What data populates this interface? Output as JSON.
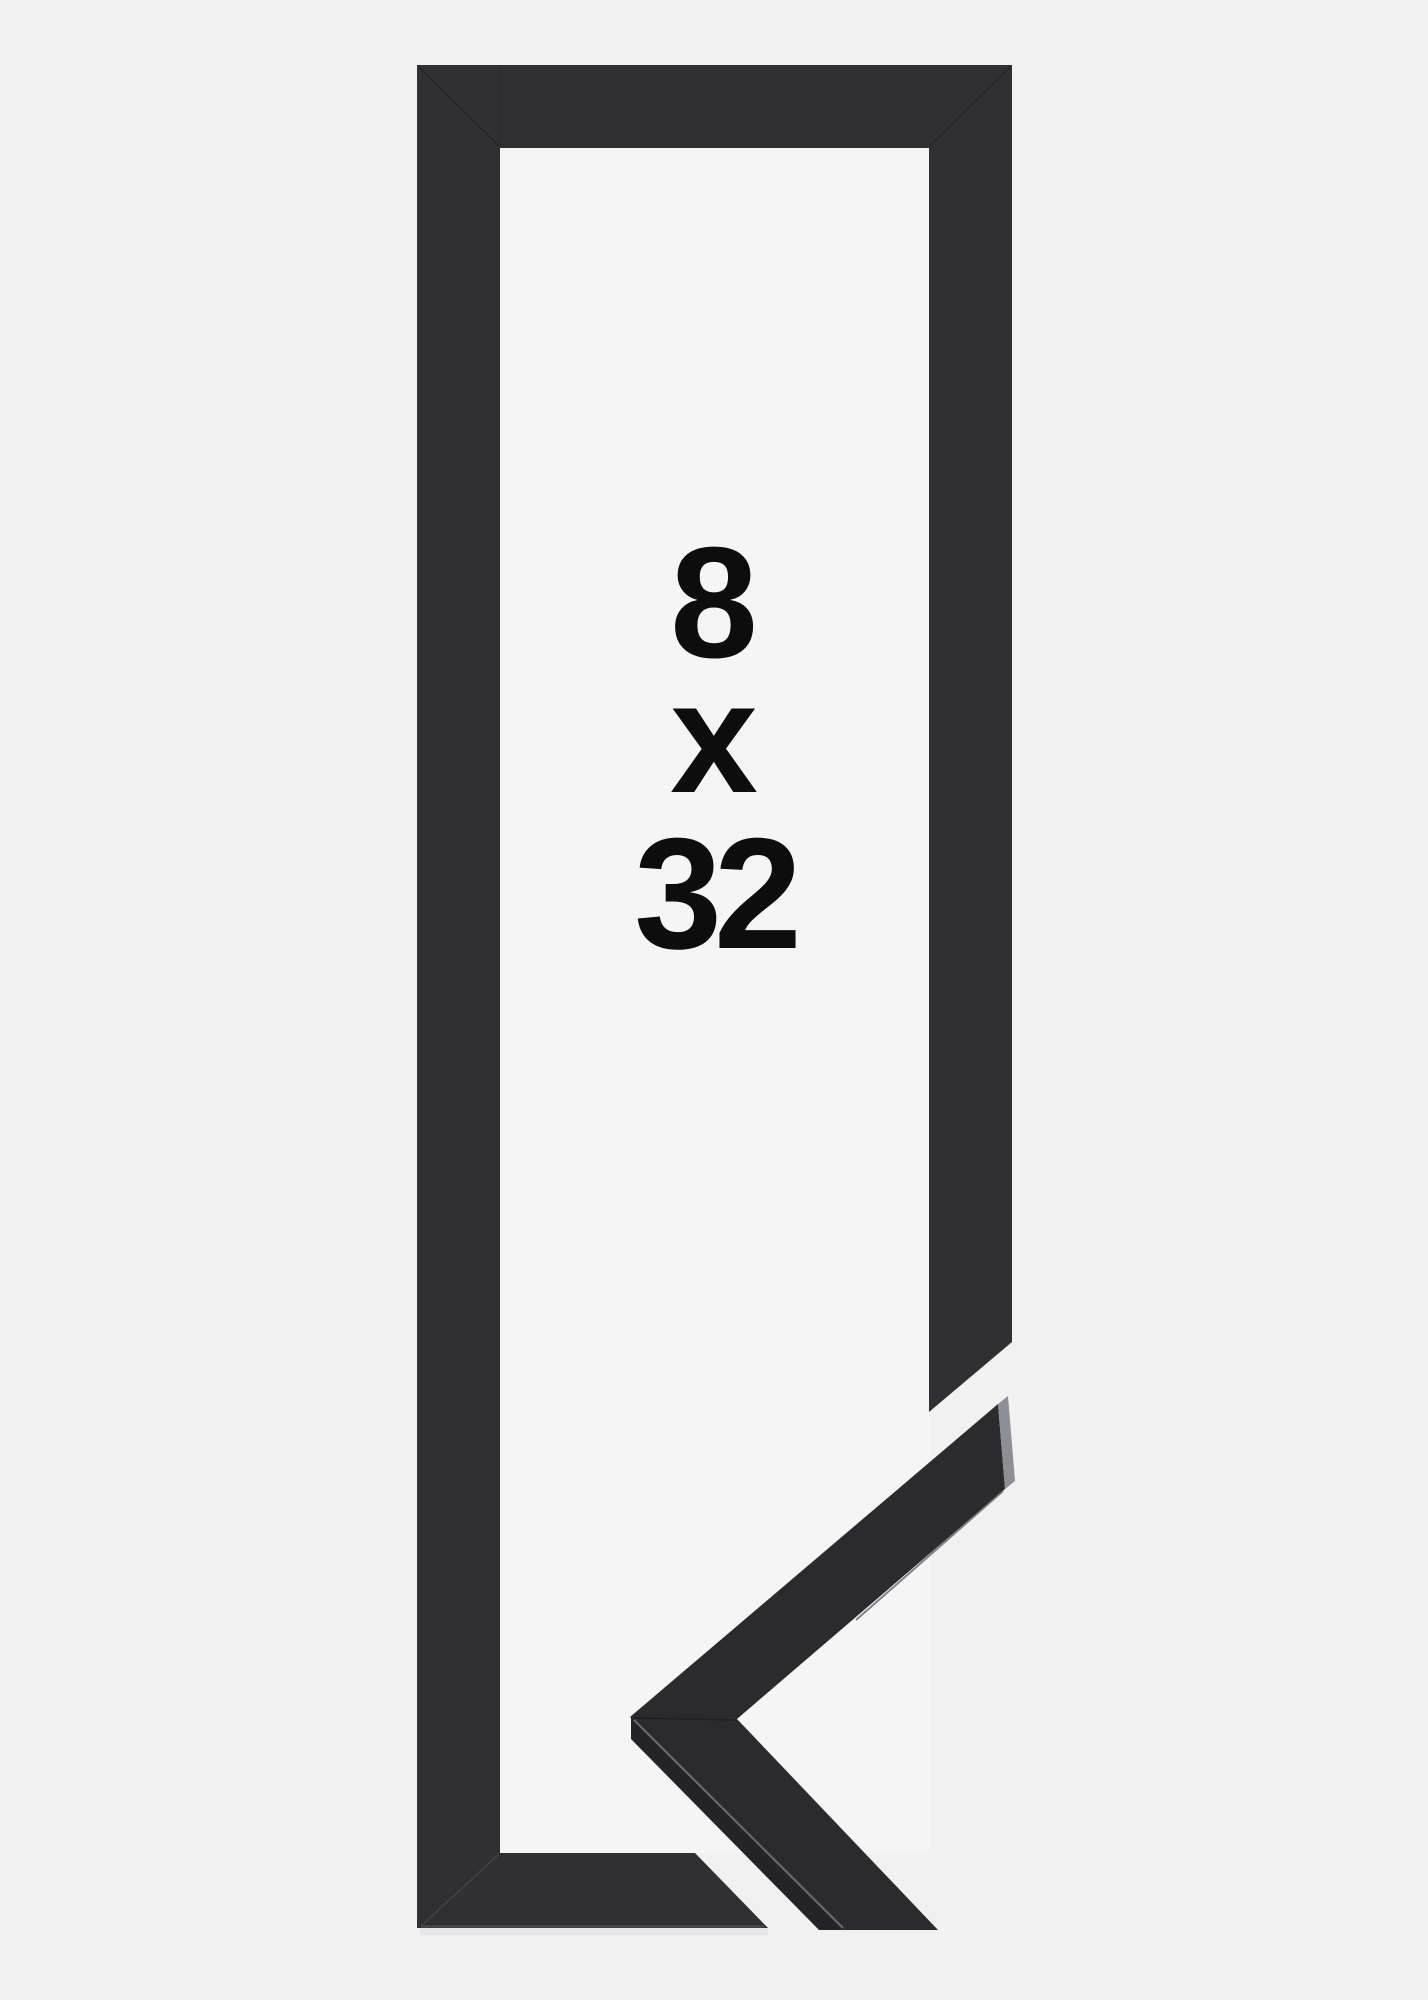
{
  "image": {
    "description": "Black picture frame in tall portrait orientation with a detached mitered corner sample at the lower right",
    "size_label": {
      "width_value": "8",
      "separator": "x",
      "height_value": "32"
    }
  },
  "colors": {
    "background": "#f1f1f2",
    "window": "#f5f5f6",
    "frame_black": "#303033",
    "sample_top_face": "#2b2b2e",
    "sample_side_face": "#242427",
    "sample_end_face": "#8e8e95",
    "label_text": "#0d0d0d",
    "shadow": "#dedee1"
  }
}
